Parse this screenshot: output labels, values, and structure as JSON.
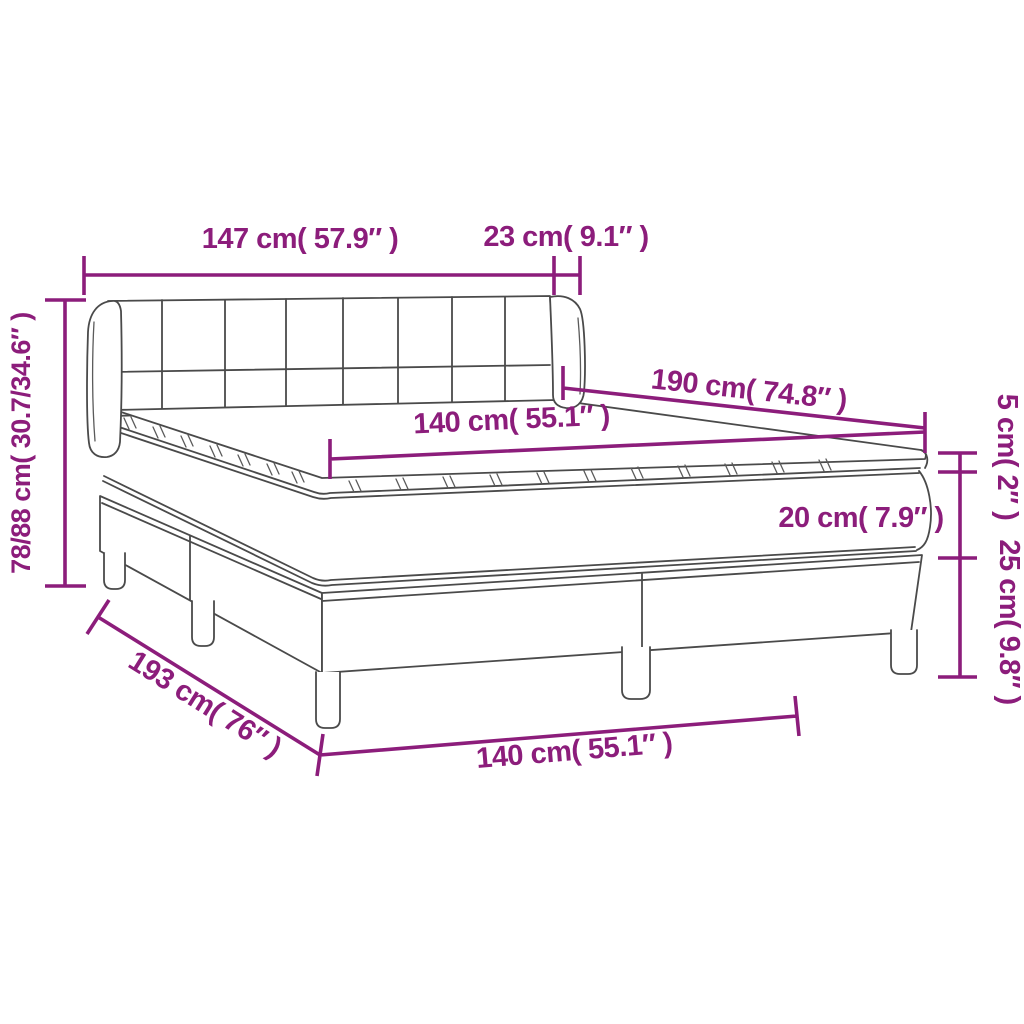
{
  "title": "Box spring bed with headboard and topper - dimension diagram",
  "colors": {
    "dimension_accent": "#8c1d7b",
    "drawing_outline": "#4a4a4a",
    "background": "#ffffff"
  },
  "dims": {
    "headboard_width": "147 cm( 57.9″ )",
    "side_bolster_depth": "23 cm( 9.1″ )",
    "total_height": "78/88 cm( 30.7/34.6″ )",
    "bed_length": "190 cm( 74.8″ )",
    "mattress_width": "140 cm( 55.1″ )",
    "topper_thickness": "5 cm( 2″ )",
    "mattress_thickness": "20 cm( 7.9″ )",
    "base_height": "25 cm( 9.8″ )",
    "base_length": "193 cm( 76″ )",
    "base_width": "140 cm( 55.1″ )"
  }
}
